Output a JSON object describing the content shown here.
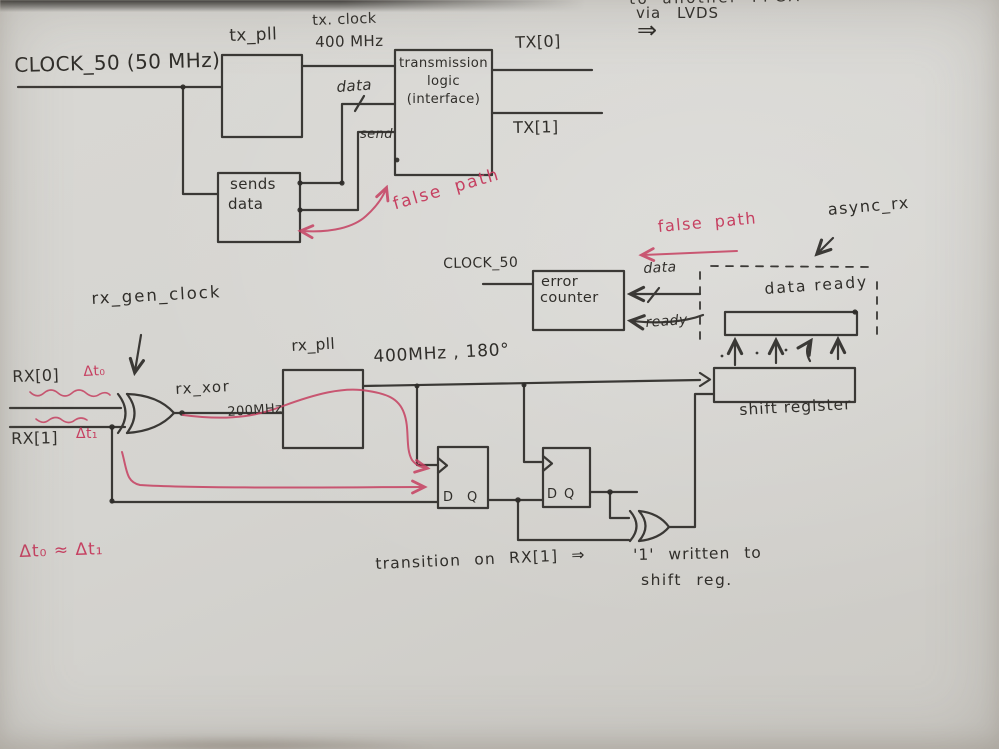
{
  "colors": {
    "ink": "#2f2d2a",
    "red": "#c64061",
    "paper": "#d5d4d0"
  },
  "top": {
    "clock_input": "CLOCK_50  (50 MHz)",
    "pll_label": "tx_pll",
    "clock_label": "tx. clock",
    "freq_label": "400 MHz",
    "data_label": "data",
    "send_label": "send",
    "sender_line1": "sends",
    "sender_line2": "data",
    "logic_line1": "transmission",
    "logic_line2": "logic",
    "logic_line3": "(interface)",
    "tx0_label": "TX[0]",
    "tx1_label": "TX[1]",
    "dest_line1": "to another FPGA",
    "dest_line2": "via LVDS",
    "dest_arrow": "⇒",
    "false_path_label": "false path"
  },
  "mid": {
    "clock_label": "CLOCK_50",
    "counter_line1": "error",
    "counter_line2": "counter",
    "data_label": "data",
    "ready_label": "ready",
    "false_path_label": "false path",
    "async_label": "async_rx"
  },
  "rx": {
    "gen_clock_label": "rx_gen_clock",
    "rx0_label": "RX[0]",
    "dt0_label": "Δt₀",
    "rx1_label": "RX[1]",
    "dt1_label": "Δt₁",
    "xor_label": "rx_xor",
    "xor_freq_label": "200MHz",
    "pll_label": "rx_pll",
    "pll_out_label": "400MHz , 180°",
    "ff_d_label": "D",
    "ff_q_label": "Q",
    "data_ready_label": "data ready",
    "shift_register_label": "shift register",
    "dt_equation": "Δt₀ ≈ Δt₁",
    "note_line1": "transition  on  RX[1]  ⇒",
    "note_line2": "'1' written to",
    "note_line3": "shift reg."
  }
}
